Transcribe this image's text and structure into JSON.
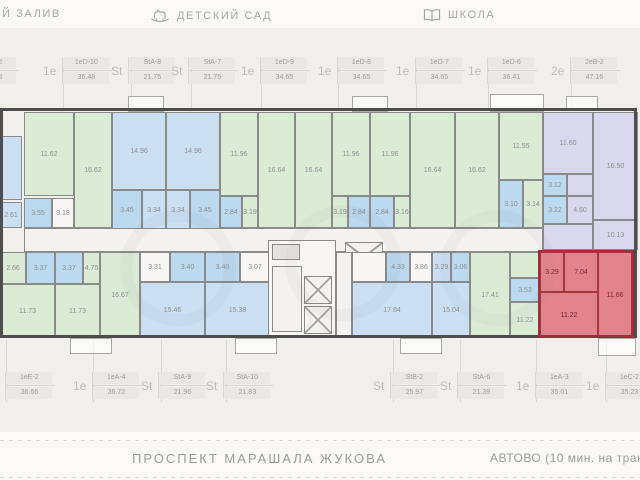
{
  "landmarks": {
    "bay": "Й ЗАЛИВ",
    "kindergarten": "ДЕТСКИЙ САД",
    "school": "ШКОЛА"
  },
  "street": {
    "avenue": "ПРОСПЕКТ МАРАШАЛА ЖУКОВА",
    "metro": "АВТОВО (10 мин. на трансп"
  },
  "selected_unit": "1еС-2",
  "colors": {
    "green": "#dcebd6",
    "blue": "#cbdff1",
    "tile": "#bcd9ee",
    "white": "#f7f6f4",
    "purple": "#d9d7ec",
    "red": "#e2848d",
    "corr": "#f3f2ef",
    "gray": "#e3e2df",
    "stairs": "#f3f2ef",
    "elev": "#f3f2ef"
  },
  "units_top": [
    {
      "type": "St",
      "code": "StC-2",
      "area": "25.88",
      "x": -26
    },
    {
      "type": "1е",
      "code": "1еD-10",
      "area": "36.48",
      "x": 65
    },
    {
      "type": "St",
      "code": "StA-8",
      "area": "21.75",
      "x": 133
    },
    {
      "type": "St",
      "code": "StA-7",
      "area": "21.75",
      "x": 193
    },
    {
      "type": "1е",
      "code": "1еD-9",
      "area": "34.65",
      "x": 263
    },
    {
      "type": "1е",
      "code": "1еD-8",
      "area": "34.65",
      "x": 340
    },
    {
      "type": "1е",
      "code": "1еD-7",
      "area": "34.65",
      "x": 418
    },
    {
      "type": "1е",
      "code": "1еD-6",
      "area": "36.41",
      "x": 490
    },
    {
      "type": "2е",
      "code": "2еВ-2",
      "area": "47.16",
      "x": 573
    }
  ],
  "units_bottom": [
    {
      "type": "1е",
      "code": "1еЕ-2",
      "area": "36.66",
      "x": 8
    },
    {
      "type": "1е",
      "code": "1еА-4",
      "area": "36.72",
      "x": 95
    },
    {
      "type": "St",
      "code": "StA-9",
      "area": "21.96",
      "x": 163
    },
    {
      "type": "St",
      "code": "StA-10",
      "area": "21.83",
      "x": 228
    },
    {
      "type": "St",
      "code": "StB-2",
      "area": "25.97",
      "x": 395
    },
    {
      "type": "St",
      "code": "StA-6",
      "area": "21.39",
      "x": 462
    },
    {
      "type": "1е",
      "code": "1еА-3",
      "area": "35.01",
      "x": 538
    },
    {
      "type": "1е",
      "code": "1еС-2",
      "area": "35.23",
      "x": 608
    }
  ],
  "plan": {
    "outline": {
      "x": 0,
      "y": 108,
      "w": 637,
      "h": 230
    },
    "red_outline": {
      "x": 538,
      "y": 250,
      "w": 96,
      "h": 88
    },
    "rooms": [
      [
        0,
        136,
        22,
        64,
        "blue",
        ""
      ],
      [
        0,
        202,
        22,
        26,
        "blue",
        "2.61"
      ],
      [
        24,
        112,
        50,
        84,
        "green",
        "11.62"
      ],
      [
        24,
        198,
        28,
        30,
        "tile",
        "3.55"
      ],
      [
        52,
        198,
        22,
        30,
        "white",
        "3.18"
      ],
      [
        74,
        112,
        38,
        116,
        "green",
        "16.62"
      ],
      [
        112,
        112,
        54,
        78,
        "blue",
        "14.96"
      ],
      [
        112,
        190,
        30,
        40,
        "tile",
        "3.45"
      ],
      [
        142,
        190,
        24,
        40,
        "blue",
        "3.34"
      ],
      [
        166,
        112,
        54,
        78,
        "blue",
        "14.96"
      ],
      [
        190,
        190,
        30,
        40,
        "tile",
        "3.45"
      ],
      [
        166,
        190,
        24,
        40,
        "blue",
        "3.34"
      ],
      [
        220,
        112,
        38,
        84,
        "green",
        "11.96"
      ],
      [
        258,
        112,
        37,
        116,
        "green",
        "16.64"
      ],
      [
        220,
        196,
        22,
        32,
        "tile",
        "2.84"
      ],
      [
        242,
        196,
        16,
        32,
        "green",
        "3.19"
      ],
      [
        332,
        112,
        38,
        84,
        "green",
        "11.96"
      ],
      [
        295,
        112,
        37,
        116,
        "green",
        "16.64"
      ],
      [
        348,
        196,
        22,
        32,
        "tile",
        "2.84"
      ],
      [
        332,
        196,
        16,
        32,
        "green",
        "3.19"
      ],
      [
        370,
        112,
        40,
        84,
        "green",
        "11.96"
      ],
      [
        410,
        112,
        45,
        116,
        "green",
        "16.64"
      ],
      [
        370,
        196,
        24,
        32,
        "tile",
        "2.84"
      ],
      [
        394,
        196,
        16,
        32,
        "green",
        "3.16"
      ],
      [
        455,
        112,
        44,
        116,
        "green",
        "16.62"
      ],
      [
        499,
        112,
        44,
        68,
        "green",
        "11.55"
      ],
      [
        499,
        180,
        24,
        48,
        "tile",
        "3.10"
      ],
      [
        523,
        180,
        20,
        48,
        "green",
        "3.14"
      ],
      [
        543,
        112,
        50,
        62,
        "purple",
        "11.60"
      ],
      [
        593,
        112,
        45,
        108,
        "purple",
        "16.50"
      ],
      [
        543,
        174,
        24,
        22,
        "tile",
        "3.12"
      ],
      [
        567,
        174,
        26,
        22,
        "purple",
        ""
      ],
      [
        543,
        196,
        24,
        28,
        "tile",
        "3.22"
      ],
      [
        567,
        196,
        26,
        28,
        "purple",
        "4.60"
      ],
      [
        543,
        224,
        50,
        26,
        "purple",
        ""
      ],
      [
        593,
        220,
        45,
        30,
        "purple",
        "10.13"
      ],
      [
        24,
        228,
        519,
        24,
        "corr",
        ""
      ],
      [
        0,
        252,
        26,
        32,
        "green",
        "2.66"
      ],
      [
        26,
        252,
        29,
        32,
        "tile",
        "3.37"
      ],
      [
        0,
        284,
        55,
        54,
        "green",
        "11.73"
      ],
      [
        55,
        252,
        28,
        32,
        "tile",
        "3.37"
      ],
      [
        83,
        252,
        17,
        32,
        "green",
        "4.75"
      ],
      [
        55,
        284,
        45,
        54,
        "green",
        "11.73"
      ],
      [
        100,
        252,
        40,
        86,
        "green",
        "16.67"
      ],
      [
        140,
        252,
        30,
        30,
        "white",
        "3.31"
      ],
      [
        170,
        252,
        35,
        30,
        "tile",
        "3.40"
      ],
      [
        140,
        282,
        65,
        56,
        "blue",
        "15.46"
      ],
      [
        205,
        252,
        35,
        30,
        "tile",
        "3.40"
      ],
      [
        240,
        252,
        30,
        30,
        "white",
        "3.07"
      ],
      [
        205,
        282,
        65,
        56,
        "blue",
        "15.38"
      ],
      [
        268,
        240,
        68,
        98,
        "white",
        ""
      ],
      [
        272,
        244,
        28,
        16,
        "gray",
        ""
      ],
      [
        272,
        266,
        30,
        66,
        "stairs",
        ""
      ],
      [
        304,
        276,
        28,
        28,
        "elev",
        ""
      ],
      [
        304,
        306,
        28,
        28,
        "elev",
        ""
      ],
      [
        345,
        242,
        38,
        30,
        "elev",
        ""
      ],
      [
        336,
        252,
        16,
        86,
        "corr",
        ""
      ],
      [
        352,
        252,
        34,
        30,
        "white",
        ""
      ],
      [
        386,
        252,
        24,
        30,
        "tile",
        "4.33"
      ],
      [
        410,
        252,
        22,
        30,
        "white",
        "3.86"
      ],
      [
        352,
        282,
        80,
        56,
        "blue",
        "17.84"
      ],
      [
        432,
        252,
        19,
        30,
        "blue",
        "3.29"
      ],
      [
        451,
        252,
        19,
        30,
        "tile",
        "3.06"
      ],
      [
        432,
        282,
        38,
        56,
        "blue",
        "15.04"
      ],
      [
        470,
        252,
        40,
        86,
        "green",
        "17.41"
      ],
      [
        510,
        252,
        30,
        26,
        "green",
        ""
      ],
      [
        510,
        278,
        30,
        24,
        "tile",
        "3.53"
      ],
      [
        510,
        302,
        30,
        36,
        "green",
        "11.22"
      ],
      [
        540,
        252,
        24,
        40,
        "red",
        "3.29"
      ],
      [
        564,
        252,
        34,
        40,
        "red",
        "7.04"
      ],
      [
        598,
        252,
        34,
        86,
        "red",
        "11.66"
      ],
      [
        540,
        292,
        58,
        46,
        "red",
        "11.22"
      ]
    ],
    "balconies": [
      [
        128,
        96,
        34,
        14
      ],
      [
        352,
        96,
        34,
        14
      ],
      [
        490,
        94,
        52,
        16
      ],
      [
        566,
        96,
        30,
        12
      ],
      [
        70,
        338,
        40,
        14
      ],
      [
        235,
        338,
        40,
        14
      ],
      [
        400,
        338,
        40,
        14
      ],
      [
        598,
        338,
        36,
        16
      ]
    ],
    "dividers_top": [
      63,
      131,
      191,
      261,
      338,
      416,
      488,
      571
    ],
    "dividers_bottom": [
      6,
      93,
      161,
      226,
      393,
      460,
      536,
      606
    ]
  }
}
